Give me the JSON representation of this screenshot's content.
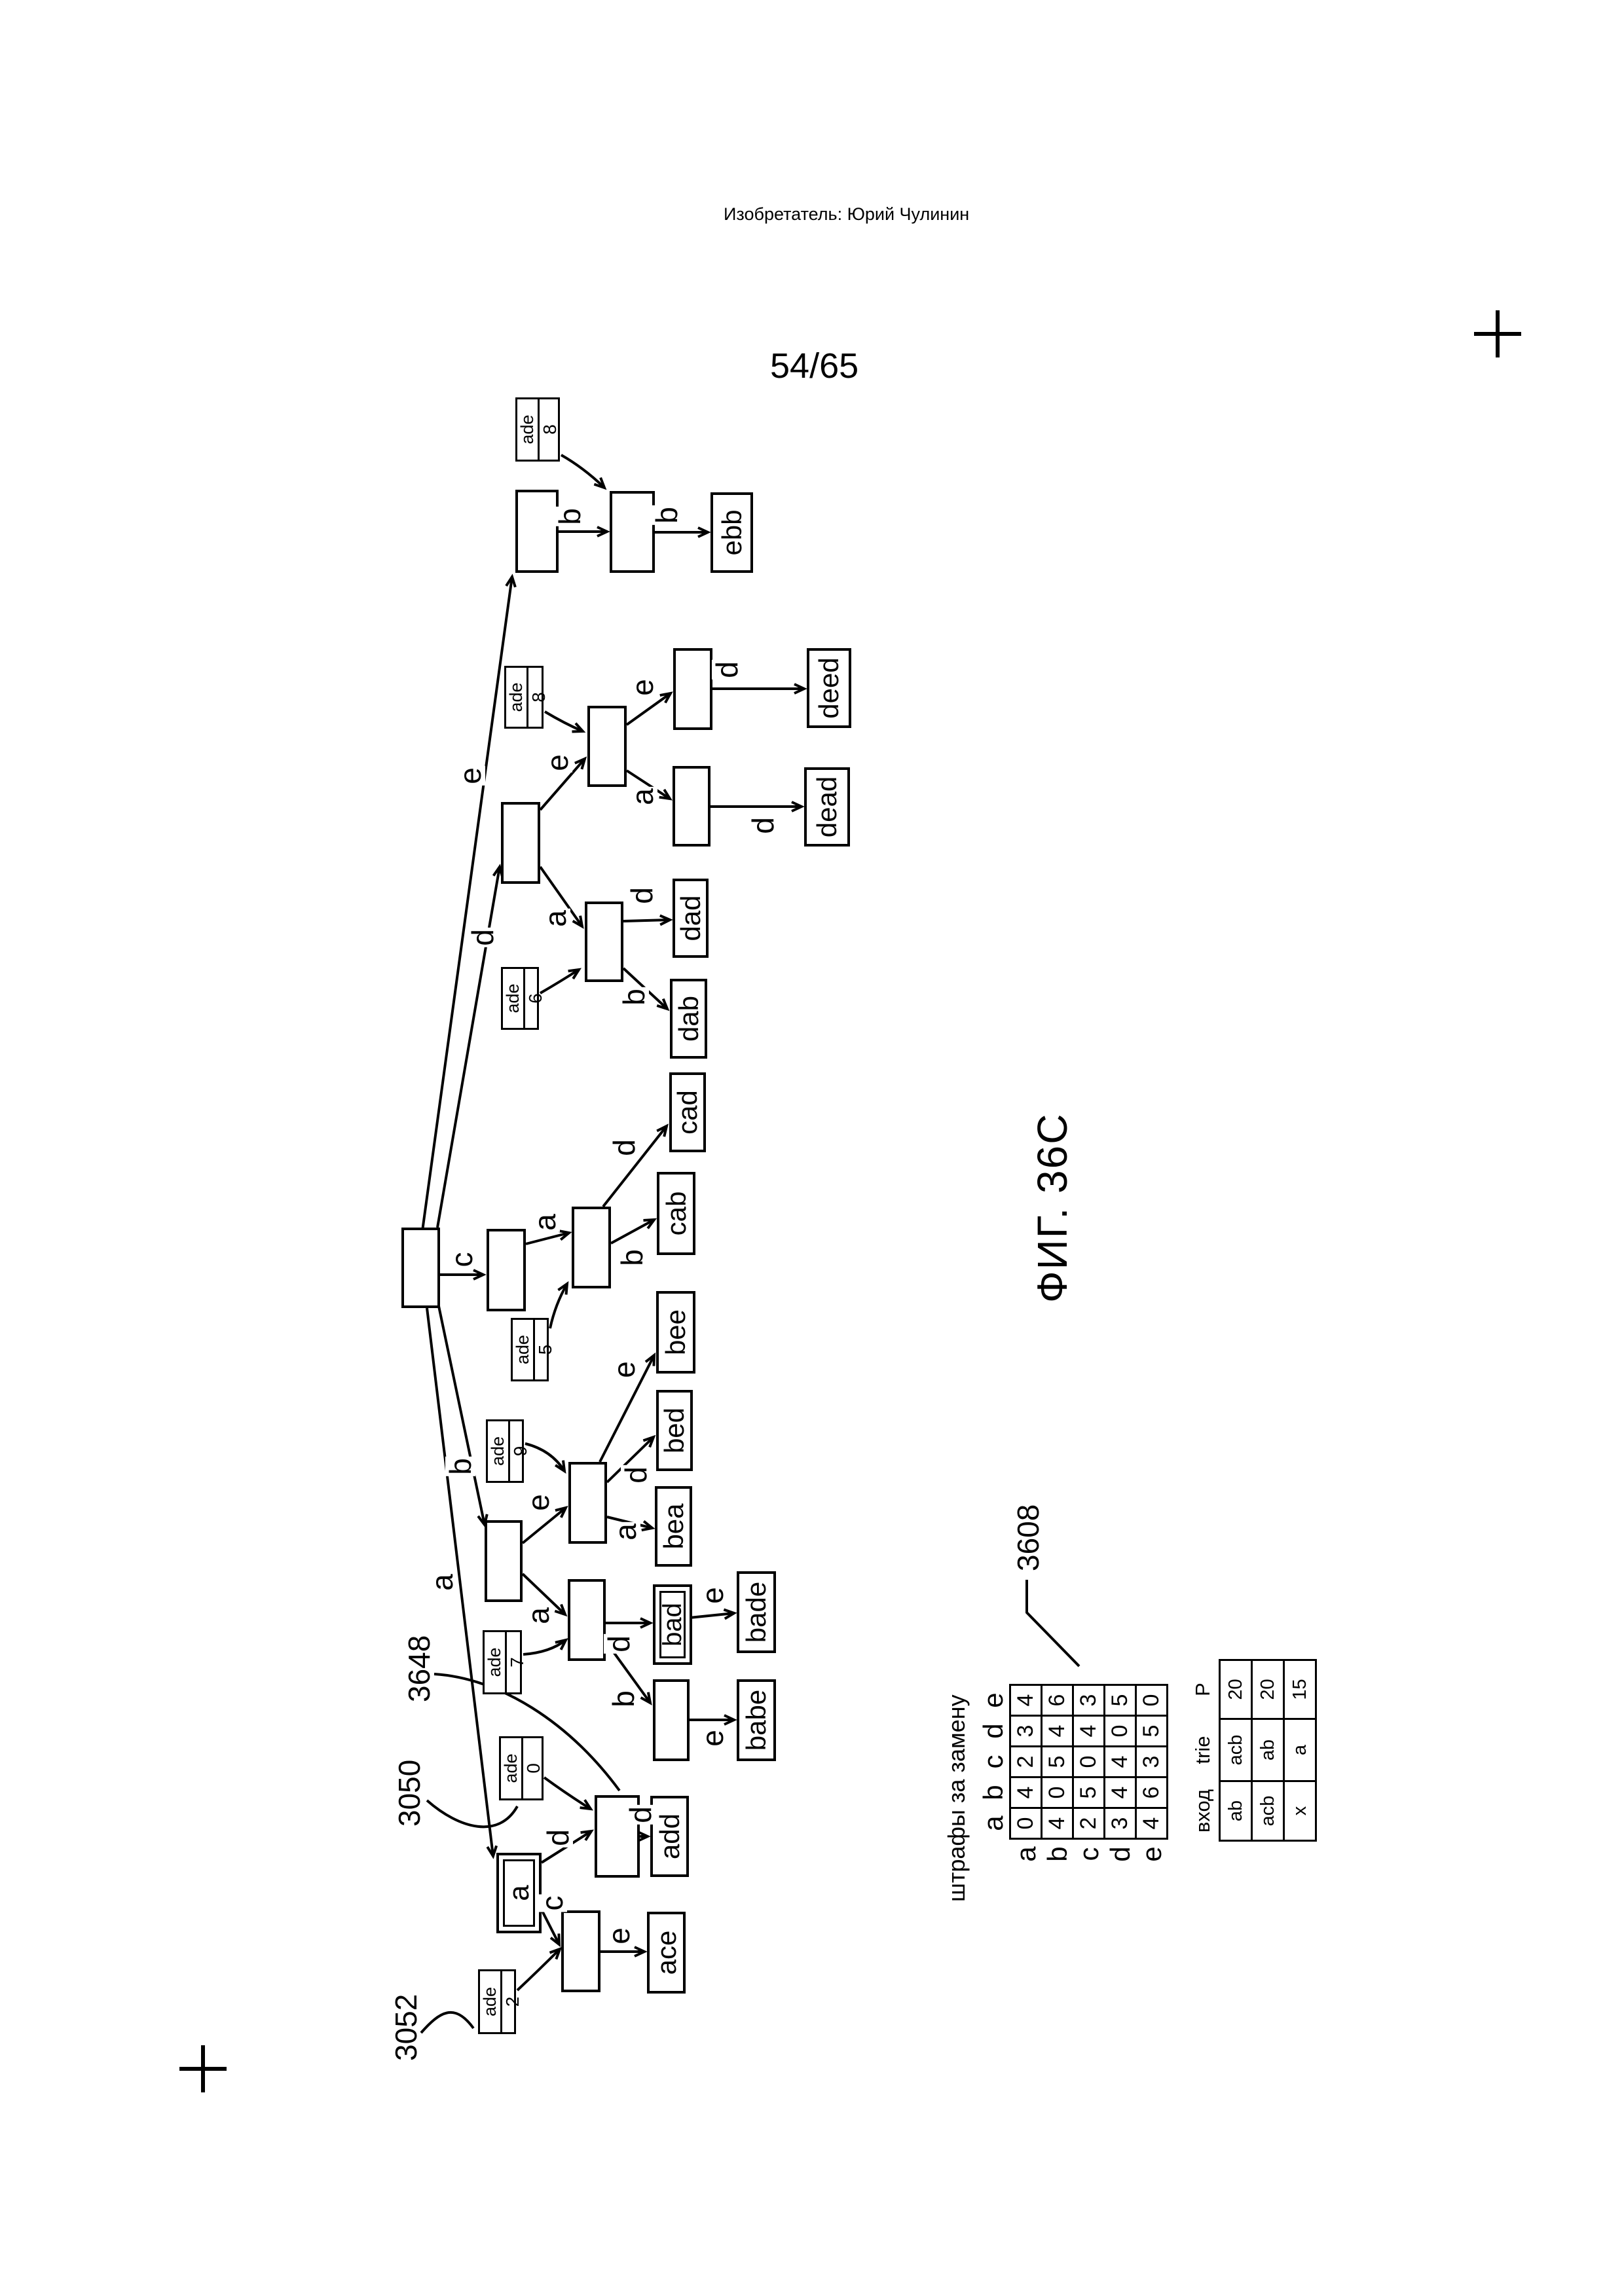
{
  "page": {
    "inventor_line": "Изобретатель: Юрий Чулинин",
    "page_number": "54/65",
    "figure_caption": "ФИГ. 36C"
  },
  "ref_labels": {
    "r3050": "3050",
    "r3052": "3052",
    "r3648": "3648",
    "r3608": "3608"
  },
  "trie": {
    "a_node_label": "a",
    "ade_label": "ade",
    "ade_boxes": {
      "b2": "2",
      "b0": "0",
      "b7": "7",
      "b9": "9",
      "b5": "5",
      "b6": "6",
      "b8d": "8",
      "b8e": "8"
    },
    "leaves": {
      "ace": "ace",
      "add": "add",
      "babe": "babe",
      "bad": "bad",
      "bade": "bade",
      "bea": "bea",
      "bed": "bed",
      "bee": "bee",
      "cab": "cab",
      "cad": "cad",
      "dab": "dab",
      "dad": "dad",
      "dead": "dead",
      "deed": "deed",
      "ebb": "ebb"
    },
    "edge_labels": {
      "root_a": "a",
      "root_b": "b",
      "root_c": "c",
      "root_d": "d",
      "root_e": "e",
      "a_ad": "d",
      "a_ac": "c",
      "ad_add": "d",
      "ac_ace": "e",
      "b_ba": "a",
      "b_be": "e",
      "ba_bad": "d",
      "ba_bab": "b",
      "bab_babe": "e",
      "bad_bade": "e",
      "be_bea": "a",
      "be_bed": "d",
      "be_bee": "e",
      "c_ca": "a",
      "ca_cab": "b",
      "ca_cad": "d",
      "d_da": "a",
      "d_de": "e",
      "da_dad": "d",
      "da_dab": "b",
      "de_dee": "e",
      "de_dea": "a",
      "dee_deed": "d",
      "dea_dead": "d",
      "e_eb": "b",
      "eb_ebb": "b"
    }
  },
  "substitution_table": {
    "title": "штрафы за замену",
    "col_headers": [
      "a",
      "b",
      "c",
      "d",
      "e"
    ],
    "row_headers": [
      "a",
      "b",
      "c",
      "d",
      "e"
    ],
    "rows": [
      [
        "0",
        "4",
        "2",
        "3",
        "4"
      ],
      [
        "4",
        "0",
        "5",
        "4",
        "6"
      ],
      [
        "2",
        "5",
        "0",
        "4",
        "3"
      ],
      [
        "3",
        "4",
        "4",
        "0",
        "5"
      ],
      [
        "4",
        "6",
        "3",
        "5",
        "0"
      ]
    ]
  },
  "input_table": {
    "headers": [
      "вход",
      "trie",
      "P"
    ],
    "rows": [
      [
        "ab",
        "acb",
        "20"
      ],
      [
        "acb",
        "ab",
        "20"
      ],
      [
        "x",
        "a",
        "15"
      ]
    ]
  }
}
